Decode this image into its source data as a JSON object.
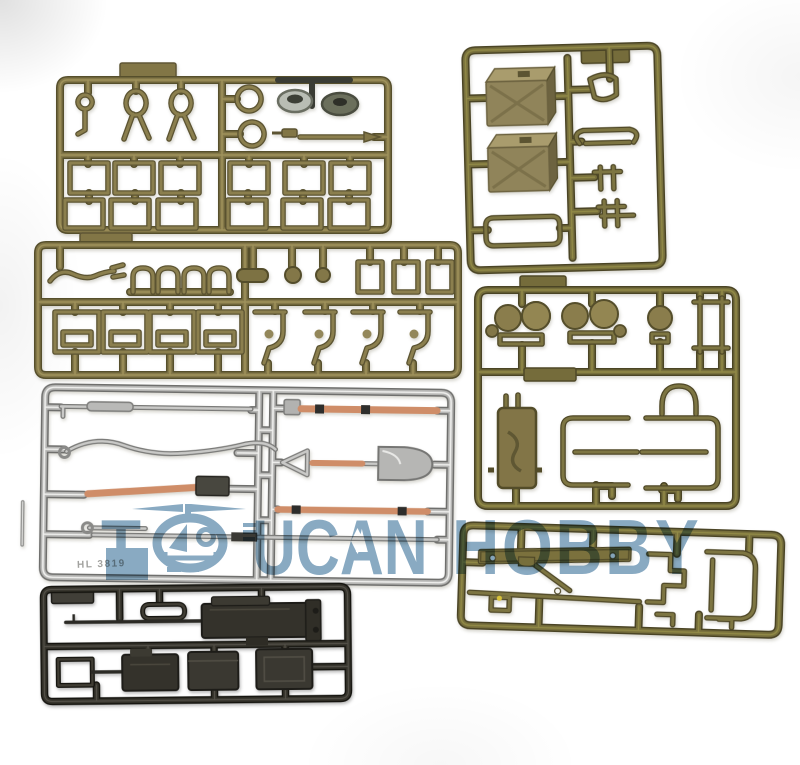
{
  "page": {
    "type": "product-photo",
    "background_color": "#ffffff",
    "subject": "Plastic model kit sprues (runner frames with parts) for RC tank accessory set"
  },
  "watermark": {
    "full_text": "TOUCANHOBBY",
    "word1_prefix": "T",
    "word1_suffix": "UCAN",
    "word2": "HOBBY",
    "color": "#4b7da3",
    "logo": "toucan-helicopter-in-circle-logo"
  },
  "sprues": {
    "top_left": {
      "name": "hatch frames, clips and rings sprue",
      "plastic": "olive drab",
      "color": "#847849"
    },
    "top_right": {
      "name": "fuel cans and clamps sprue",
      "plastic": "olive drab",
      "color": "#776f3c",
      "fuel_can_color": "#a2956a"
    },
    "middle": {
      "name": "brackets, staples and clamps sprue",
      "plastic": "olive drab",
      "color": "#847849"
    },
    "right": {
      "name": "headlights and stowage racks sprue",
      "plastic": "olive drab",
      "color": "#776f3c"
    },
    "silver": {
      "name": "pioneer tools sprue (shovel, axe, hammer, tow cable, rods)",
      "plastic": "chrome silver",
      "color": "#b5b5b3",
      "tool_handle_color": "#cf8d68",
      "molded_label": "HL 3819"
    },
    "bottom_right": {
      "name": "fender plate and brackets sprue",
      "plastic": "olive drab",
      "color": "#776f3c",
      "accent_dot_color": "#d8c23a"
    },
    "bottom_left": {
      "name": "machine guns and ammo boxes sprue",
      "plastic": "gunmetal black",
      "color": "#34322b"
    }
  }
}
